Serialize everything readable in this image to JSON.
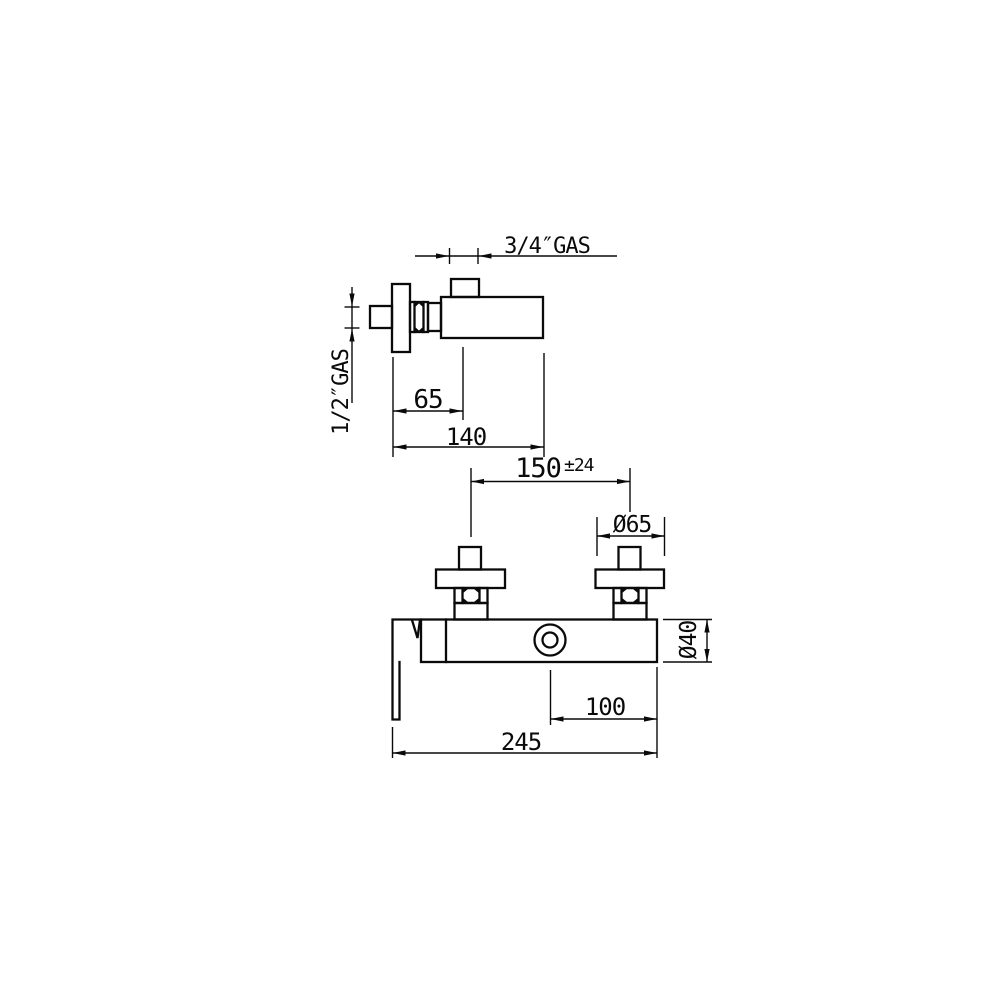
{
  "drawing": {
    "background_color": "#ffffff",
    "line_color": "#0a0a0a",
    "side_view": {
      "labels": {
        "outlet_thread": "3/4″GAS",
        "inlet_thread": "1/2″GAS",
        "wall_to_outlet_center": "65",
        "wall_to_body_end": "140"
      }
    },
    "front_view": {
      "labels": {
        "inlet_spacing": "150",
        "inlet_spacing_tolerance": "±24",
        "inlet_flange_diameter": "Ø65",
        "body_diameter": "Ø40",
        "button_to_body_end": "100",
        "overall_width": "245"
      }
    }
  }
}
